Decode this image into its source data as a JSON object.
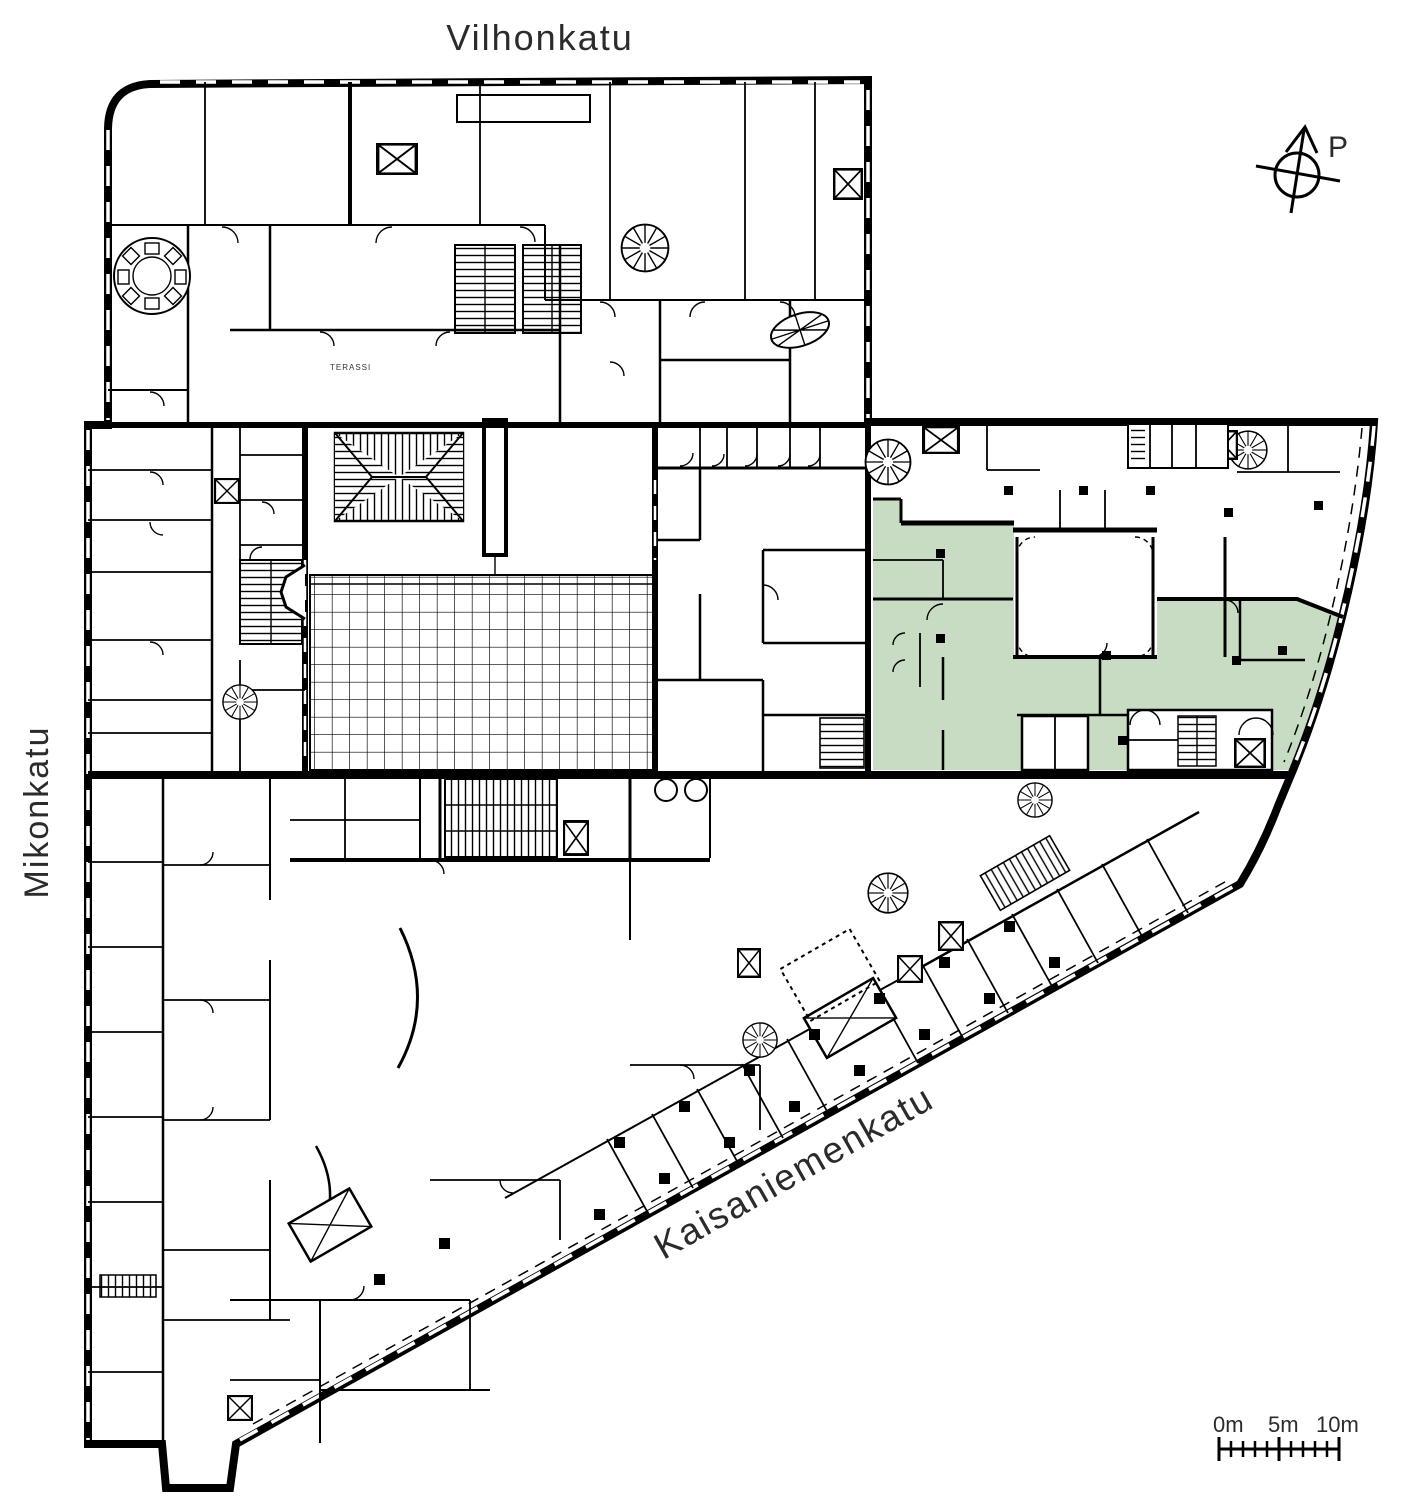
{
  "plan": {
    "streets": {
      "top": "Vilhonkatu",
      "left": "Mikonkatu",
      "bottom": "Kaisaniemenkatu"
    },
    "compass": {
      "label": "P"
    },
    "scale_bar": {
      "labels": [
        "0m",
        "5m",
        "10m"
      ]
    },
    "annotations": {
      "terrace": "TERASSI"
    },
    "colors": {
      "highlight_green": "#c7dcc2",
      "line_black": "#000000"
    }
  }
}
